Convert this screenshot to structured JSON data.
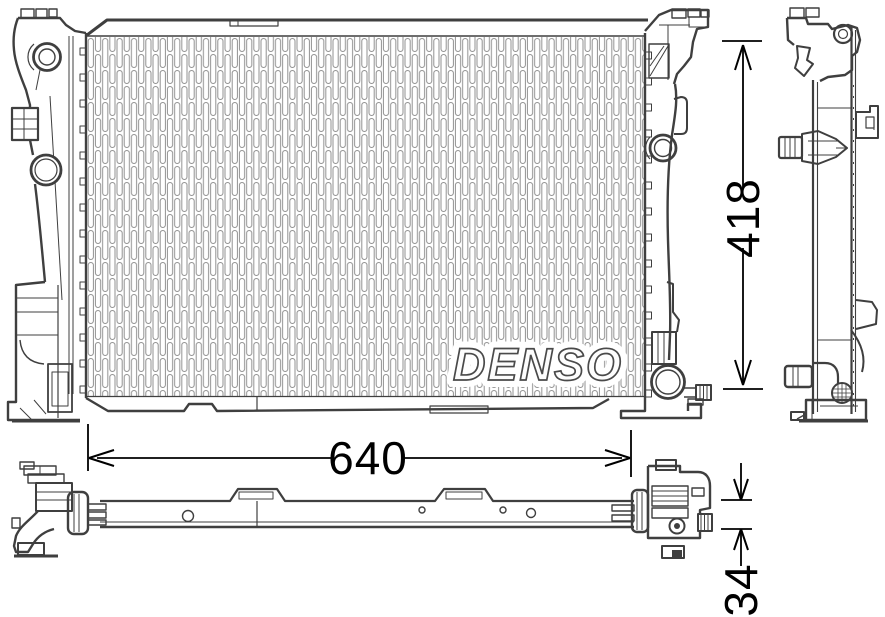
{
  "drawing": {
    "brand_watermark": "DENSO",
    "dimensions": {
      "height_mm": "418",
      "width_mm": "640",
      "depth_mm": "34"
    },
    "colors": {
      "outline": "#3f3f3f",
      "fin": "#929292",
      "dimension": "#000000",
      "watermark_fill": "#fdfdfd",
      "watermark_outline": "#4a4a4a",
      "background": "#ffffff"
    }
  }
}
